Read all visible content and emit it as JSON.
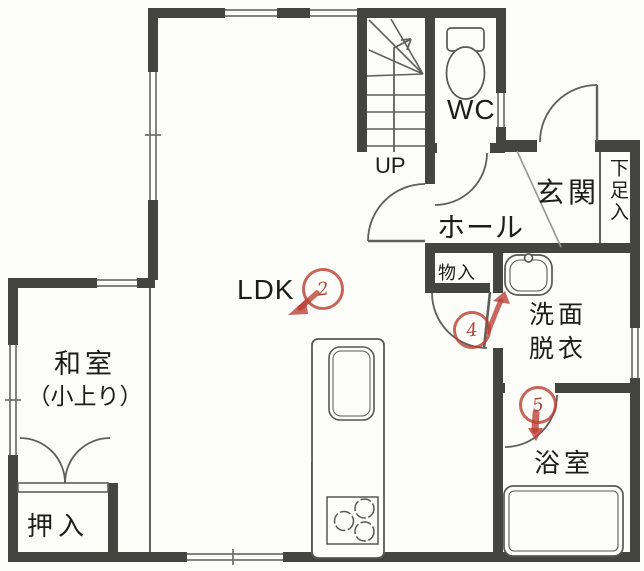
{
  "title": "1F floor plan (scanned)",
  "colors": {
    "wall": "#45453f",
    "thin_line": "#5f5f5b",
    "window_line": "#70706c",
    "red_pen": "#ba3e32",
    "text": "#1c1c1a",
    "background": "#fcfcf9"
  },
  "labels": {
    "ldk": "LDK",
    "washitsu": "和室",
    "washitsu_note": "（小上り）",
    "oshiire": "押入",
    "monoire": "物入",
    "hall": "ホール",
    "genkan": "玄関",
    "shoe_box": "下足入",
    "wc": "WC",
    "stairs_up": "UP",
    "senmen": "洗面",
    "datsui": "脱衣",
    "bath": "浴室"
  },
  "red_circled_numbers": {
    "ldk_door": "2",
    "washroom_door": "4",
    "bath_door": "5"
  },
  "fixtures": [
    "toilet-icon",
    "washbasin-icon",
    "bathtub-icon",
    "kitchen-counter-icon",
    "kitchen-sink-icon",
    "stove-icon",
    "staircase-icon"
  ]
}
